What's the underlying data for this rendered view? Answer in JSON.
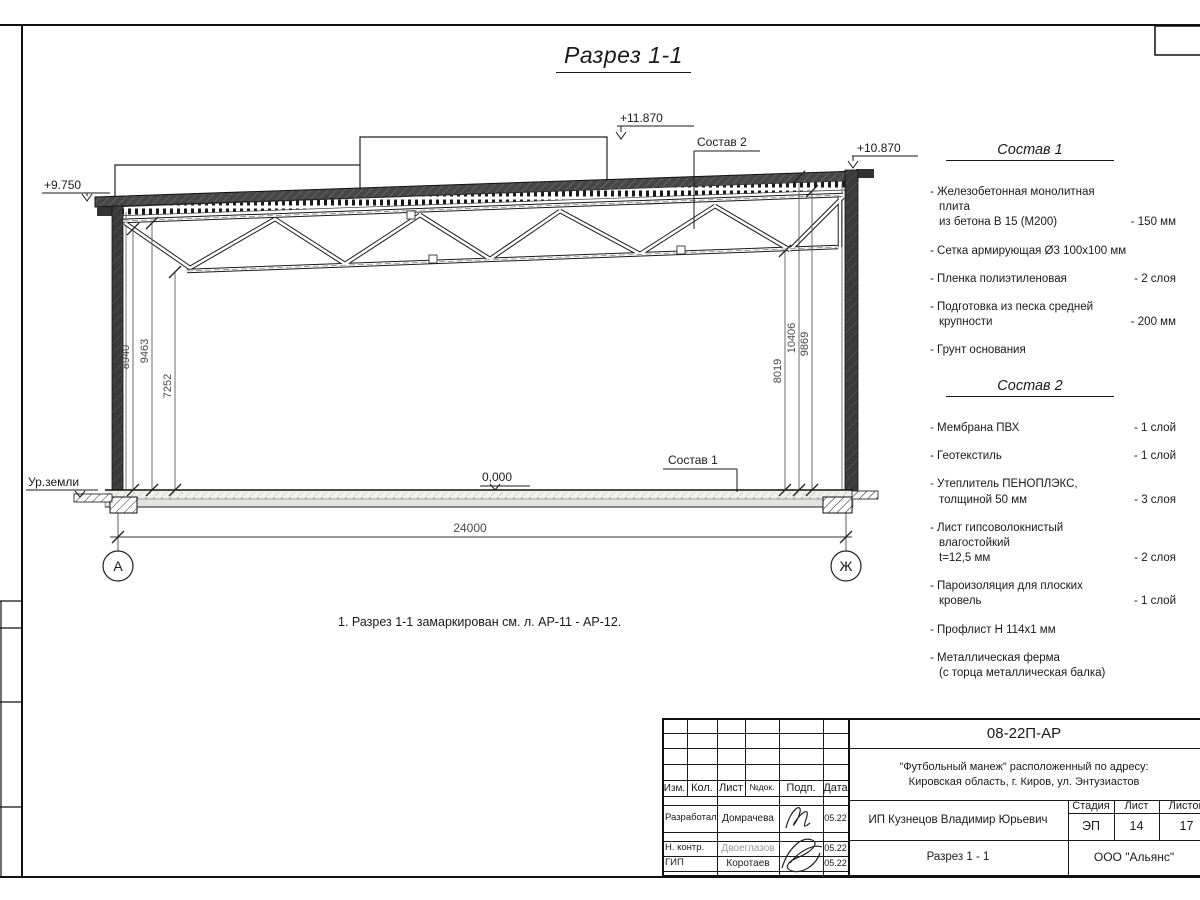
{
  "sheet": {
    "title": "Разрез 1-1",
    "note": "1. Разрез 1-1 замаркирован см. л. АР-11 - АР-12."
  },
  "drawing": {
    "levels": {
      "roof_left": "+9.750",
      "lantern_top": "+11.870",
      "roof_right": "+10.870",
      "floor": "0,000",
      "ground": "Ур.земли"
    },
    "leaders": {
      "comp1": "Состав 1",
      "comp2": "Состав 2"
    },
    "dims": {
      "span": "24000",
      "left": [
        "8940",
        "9463",
        "7252"
      ],
      "right": [
        "8019",
        "10406",
        "9869"
      ]
    },
    "axes": {
      "left": "А",
      "right": "Ж"
    }
  },
  "comp1": {
    "heading": "Состав 1",
    "items": [
      {
        "name": "- Железобетонная  монолитная плита\nиз бетона В 15 (М200)",
        "value": "- 150 мм"
      },
      {
        "name": "- Сетка армирующая Ø3 100x100 мм",
        "value": ""
      },
      {
        "name": "- Пленка полиэтиленовая",
        "value": "- 2 слоя"
      },
      {
        "name": "- Подготовка из песка средней\nкрупности",
        "value": "- 200 мм"
      },
      {
        "name": "- Грунт основания",
        "value": ""
      }
    ]
  },
  "comp2": {
    "heading": "Состав 2",
    "items": [
      {
        "name": "- Мембрана ПВХ",
        "value": "- 1 слой"
      },
      {
        "name": "- Геотекстиль",
        "value": "- 1 слой"
      },
      {
        "name": "- Утеплитель ПЕНОПЛЭКС,\nтолщиной 50 мм",
        "value": "- 3 слоя"
      },
      {
        "name": "- Лист гипсоволокнистый влагостойкий\nt=12,5 мм",
        "value": "- 2 слоя"
      },
      {
        "name": "- Пароизоляция для плоских кровель",
        "value": "- 1 слой"
      },
      {
        "name": "- Профлист Н 114х1 мм",
        "value": ""
      },
      {
        "name": "- Металлическая ферма\n(с торца металлическая балка)",
        "value": ""
      }
    ]
  },
  "titleblock": {
    "doc_number": "08-22П-АР",
    "project": "\"Футбольный манеж\" расположенный по адресу:\nКировская область, г. Киров, ул. Энтузиастов",
    "client": "ИП Кузнецов Владимир Юрьевич",
    "sheet_title": "Разрез 1 - 1",
    "company": "ООО \"Альянс\"",
    "columns": {
      "izm": "Изм.",
      "kol": "Кол.",
      "list": "Лист",
      "ndok": "№док.",
      "podp": "Подп.",
      "data": "Дата"
    },
    "stage_label": "Стадия",
    "sheet_label": "Лист",
    "sheets_label": "Листов",
    "stage": "ЭП",
    "sheet_no": "14",
    "sheets_total": "17",
    "rows": [
      {
        "role": "Разработал",
        "name": "Домрачева",
        "date": "05.22"
      },
      {
        "role": "Н. контр.",
        "name": "Двоеглазов",
        "date": "05.22"
      },
      {
        "role": "ГИП",
        "name": "Коротаев",
        "date": "05.22"
      }
    ]
  }
}
